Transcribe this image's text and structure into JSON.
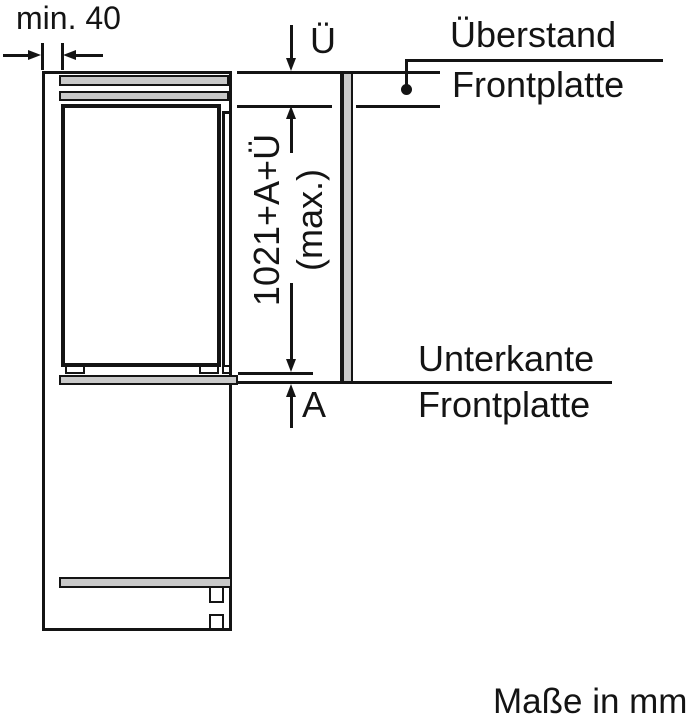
{
  "diagram": {
    "title_hint": "built-in appliance front-panel installation drawing",
    "footer": "Maße in mm",
    "dimensions": {
      "min_gap": "min. 40",
      "overhang_symbol": "Ü",
      "panel_height_formula": "1021+A+Ü",
      "panel_height_max_note": "(max.)",
      "lower_extension_symbol": "A"
    },
    "labels": {
      "ueberstand_line1": "Überstand",
      "ueberstand_line2": "Frontplatte",
      "unterkante_line1": "Unterkante",
      "unterkante_line2": "Frontplatte"
    },
    "colors": {
      "line": "#141414",
      "panel_fill": "#c9c9c9",
      "background": "#ffffff"
    }
  }
}
